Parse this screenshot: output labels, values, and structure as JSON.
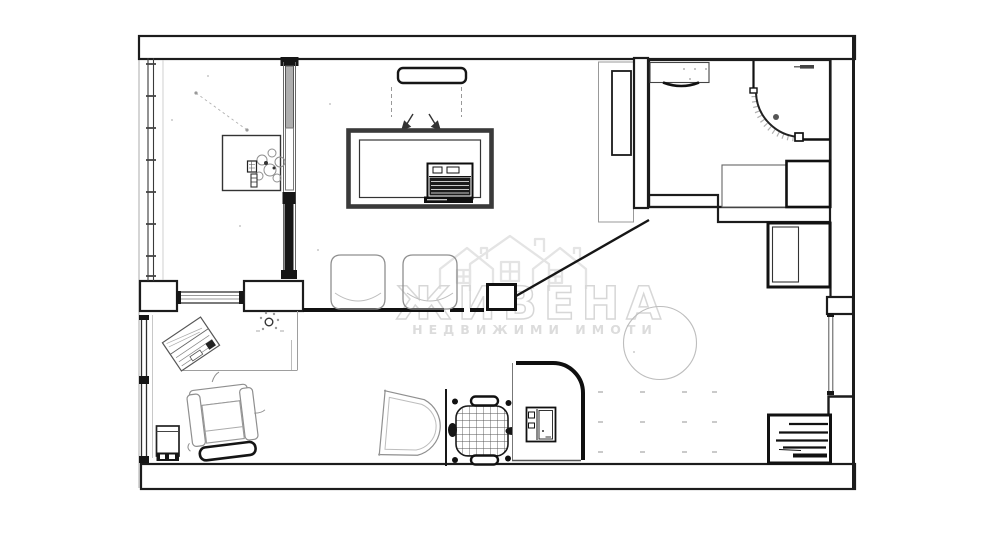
{
  "watermark": {
    "brand": "ЖИВЕНА",
    "tagline": "НЕДВИЖИМИ ИМОТИ",
    "color_outline": "#d7d7d7",
    "color_fill": "#dcdcdc"
  },
  "palette": {
    "background": "#ffffff",
    "wall_line": "#1c1c1c",
    "sketch_line": "#8f8f8f",
    "light_line": "#bdbdbd"
  },
  "icons": {
    "window-icon": "double-line-with-tick-marks",
    "sliding-door-icon": "vertical-track-with-gray-and-black-panels",
    "pass-through-window-icon": "double-line-strip-with-end-caps",
    "pendant-cord-icon": "dotted-diagonal-line",
    "dining-table-icon": "thick-double-border-rectangle",
    "laptop-icon": "dark-rect-with-keyboard-lines",
    "tv-icon": "rounded-slim-rectangle",
    "swing-arrow-icon": "small-down-arrow",
    "dining-chair-icon": "rounded-square-sketch",
    "flower-vase-icon": "circle-cluster-sketch",
    "wardrobe-column-icon": "tall-rect-with-inner-door",
    "sink-counter-icon": "rect-with-basin-arc",
    "corner-shower-icon": "quarter-circle-arc-with-hatch",
    "washing-machine-icon": "bold-bordered-square",
    "bath-counter-icon": "thin-bordered-rect",
    "closet-icon": "bold-rect-with-inner-panel",
    "radiator-icon": "bold-rect-with-slats",
    "round-rug-icon": "thin-outline-circle",
    "entry-post-icon": "small-bold-square",
    "diagonal-wall-icon": "slanted-line",
    "floor-dots-icon": "faint-dash-grid",
    "armchair-icon": "sketch-chair-with-dark-ottoman-bar",
    "angled-laptop-icon": "rotated-laptop-sketch",
    "potted-plant-icon": "small-circle-with-dots",
    "floor-cabinet-icon": "small-rect-with-dark-base",
    "guest-chair-icon": "d-shape-sketch",
    "office-chair-icon": "cross-hatched-seat-with-armrest-bars",
    "desk-icon": "rounded-corner-desk-outline",
    "monitor-icon": "split-rectangle"
  }
}
